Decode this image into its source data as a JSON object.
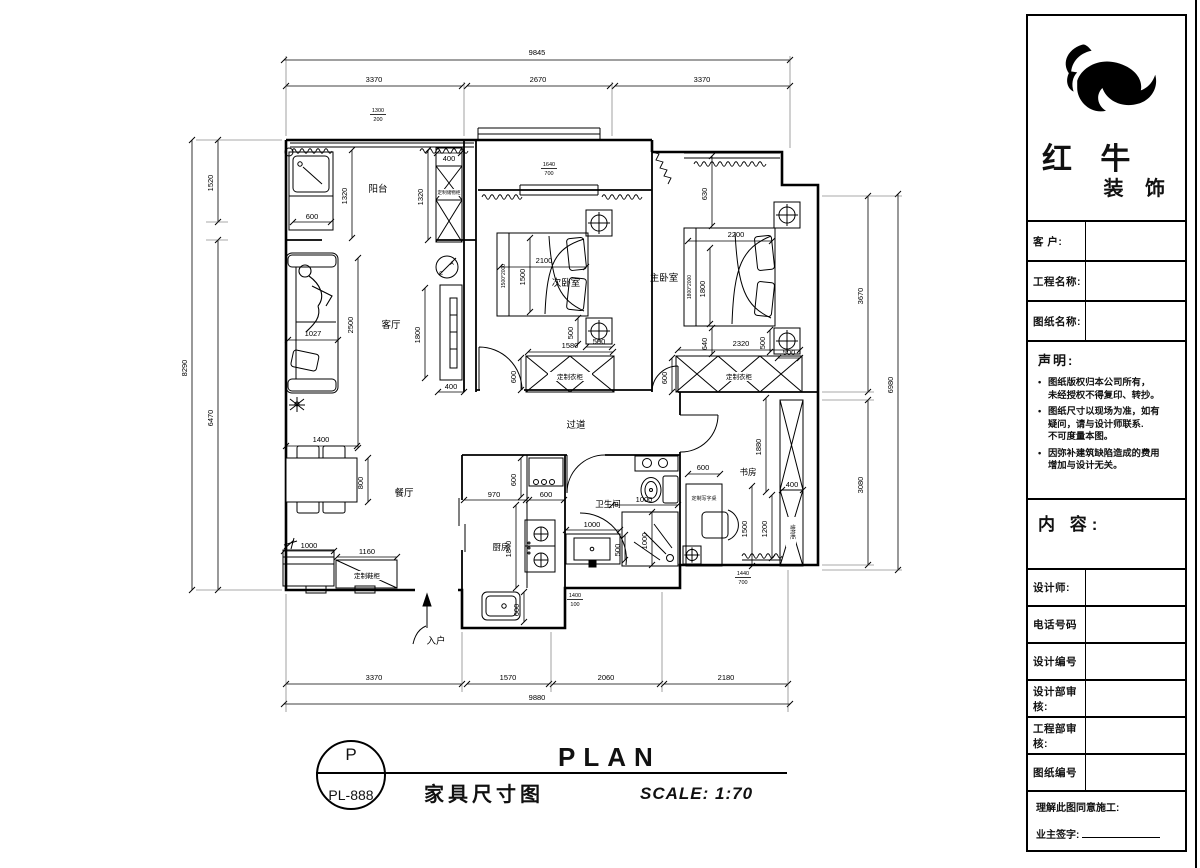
{
  "plan": {
    "rooms": {
      "balcony": "阳台",
      "living": "客厅",
      "bedroom2": "次卧室",
      "master": "主卧室",
      "hallway": "过道",
      "dining": "餐厅",
      "kitchen": "厨房",
      "bathroom": "卫生间",
      "study": "书房"
    },
    "entry": "入户",
    "furniture": {
      "wardrobe_bedroom2": "定制衣柜",
      "wardrobe_master": "定制衣柜",
      "balcony_cabinet": "定制储物柜",
      "shoe_cabinet": "定制鞋柜",
      "desk": "定制写字桌",
      "study_cabinet": "储物柜",
      "bed2_size": "1500*2000",
      "master_bed_size": "1800*2000",
      "ac_a": "A",
      "ac_c": "C"
    },
    "dims": {
      "top_total": "9845",
      "top_segs": [
        "3370",
        "2670",
        "3370"
      ],
      "bottom_segs": [
        "3370",
        "1570",
        "2060",
        "2180"
      ],
      "bottom_total": "9880",
      "left_total": "8290",
      "left_segs": [
        "1520",
        "6470"
      ],
      "right_total": "6980",
      "right_segs": [
        "3670",
        "3080"
      ],
      "balcony": [
        "600",
        "1320",
        "400",
        "1320"
      ],
      "living": [
        "2500",
        "1027",
        "1800",
        "400"
      ],
      "bedroom2": [
        "2100",
        "1500",
        "500",
        "500",
        "1580",
        "600"
      ],
      "master": [
        "630",
        "2200",
        "1800",
        "640",
        "2320",
        "500",
        "500",
        "600"
      ],
      "dining": [
        "1400",
        "800",
        "1000",
        "1160"
      ],
      "kitchen": [
        "970",
        "600",
        "600",
        "1840",
        "600"
      ],
      "bathroom": [
        "1000",
        "1000",
        "1000",
        "500"
      ],
      "study": [
        "600",
        "1500",
        "1200",
        "1880",
        "400"
      ]
    },
    "fractions": [
      {
        "top": "1300",
        "bottom": "200"
      },
      {
        "top": "1640",
        "bottom": "700"
      },
      {
        "top": "1400",
        "bottom": "100"
      },
      {
        "top": "1440",
        "bottom": "700"
      }
    ]
  },
  "title_bar": {
    "drawing_letter": "P",
    "drawing_number": "PL-888",
    "drawing_title": "家具尺寸图",
    "plan_label": "PLAN",
    "scale_label": "SCALE: 1:70"
  },
  "title_block": {
    "company_name_1": "红 牛",
    "company_name_2": "装 饰",
    "fields": [
      {
        "label": "客 户:"
      },
      {
        "label": "工程名称:"
      },
      {
        "label": "图纸名称:"
      }
    ],
    "statement_title": "声明:",
    "statement_items": [
      "图纸版权归本公司所有，\n未经授权不得复印、转抄。",
      "图纸尺寸以现场为准，如有\n疑问，请与设计师联系.\n不可度量本图。",
      "因弥补建筑缺陷造成的费用\n增加与设计无关。"
    ],
    "content_label": "内 容:",
    "info_fields": [
      {
        "label": "设计师:"
      },
      {
        "label": "电话号码"
      },
      {
        "label": "设计编号"
      },
      {
        "label": "设计部审核:"
      },
      {
        "label": "工程部审核:"
      },
      {
        "label": "图纸编号"
      }
    ],
    "agreement_label": "理解此图同意施工:",
    "signature_label": "业主签字:"
  }
}
